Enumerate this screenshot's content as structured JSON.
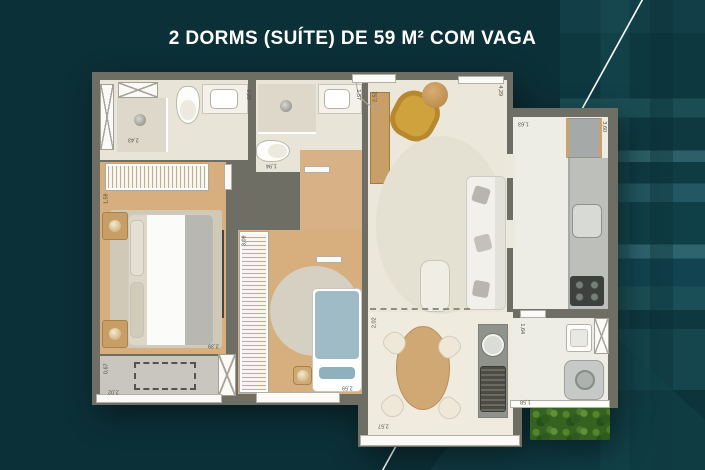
{
  "title": "2 DORMS (SUÍTE) DE 59 M² COM VAGA",
  "colors": {
    "background": "#0c3038",
    "background_stripe_light": "#2e646e",
    "wall_gray": "#6f6e65",
    "wood_floor": "#d7ae7e",
    "tile_floor": "#ece7db",
    "accent_armchair_yellow": "#d0a23d",
    "bed2_blue": "#9fbcc6",
    "greenery_green": "#35621f",
    "title_text": "#ffffff"
  },
  "measurements": {
    "suite_bath_shower": "2,43",
    "suite_bath_sink": "1,22",
    "bath2_sink": "1,57",
    "bath2_width": "1,94",
    "master_bedroom_side": "1,59",
    "master_bedroom_width": "2,39",
    "master_balcony_depth": "0,67",
    "master_balcony_width": "2,02",
    "bedroom2_depth": "3,09",
    "bedroom2_width": "2,59",
    "living_sideboard": "2,52",
    "living_depth": "4,29",
    "terrace_depth": "2,02",
    "terrace_width": "2,57",
    "kitchen_entry": "1,63",
    "kitchen_depth": "3,60",
    "service_entry": "1,64",
    "service_width": "1,58"
  }
}
